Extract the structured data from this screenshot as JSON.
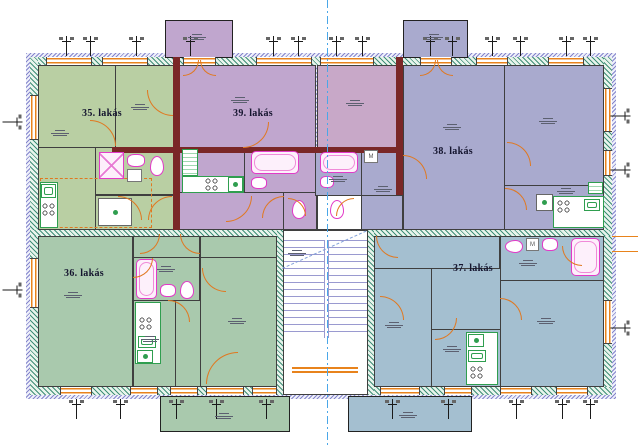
{
  "plan": {
    "apartments": [
      {
        "id": "35",
        "label": "35. lakás",
        "fill": "#b9cfa3"
      },
      {
        "id": "39",
        "label": "39. lakás",
        "fill": "#c0a6ce"
      },
      {
        "id": "38",
        "label": "38. lakás",
        "fill": "#a9aace"
      },
      {
        "id": "36",
        "label": "36. lakás",
        "fill": "#a9c9ad"
      },
      {
        "id": "37",
        "label": "37. lakás",
        "fill": "#a4bfd0"
      }
    ],
    "fixtures": {
      "washer_label": "M"
    },
    "colors": {
      "exterior_wall_hatch": "#3f8f78",
      "outer_trim_hatch": "#8585cc",
      "party_wall": "#7a2727",
      "door_swing": "#e07820",
      "window_frame": "#e8831c",
      "sanitary": "#e23ac8",
      "kitchen": "#2f9e4f",
      "centerline": "#4aa7e8",
      "stair_lines": "#9a9ad0",
      "bedroom_39": "#c8a8c8",
      "corridor": "#ffffff"
    }
  }
}
